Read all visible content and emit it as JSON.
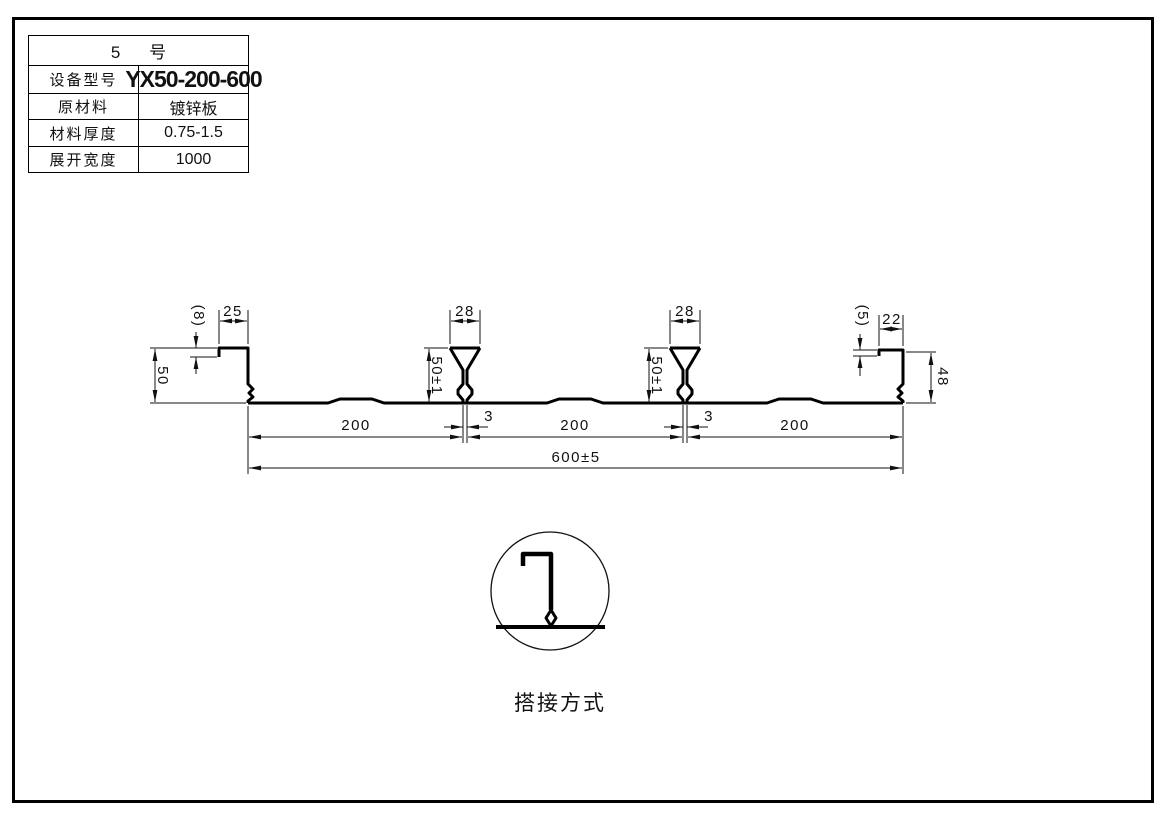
{
  "table": {
    "title": "5 号",
    "rows": [
      {
        "label": "设备型号",
        "value": "YX50-200-600"
      },
      {
        "label": "原材料",
        "value": "镀锌板"
      },
      {
        "label": "材料厚度",
        "value": "0.75-1.5"
      },
      {
        "label": "展开宽度",
        "value": "1000"
      }
    ]
  },
  "dimensions": {
    "left_height": "50",
    "left_lip": "(8)",
    "left_flange": "25",
    "rib1_top": "28",
    "rib1_height": "50±1",
    "rib1_base": "3",
    "rib2_top": "28",
    "rib2_height": "50±1",
    "rib2_base": "3",
    "right_lip": "(5)",
    "right_flange": "22",
    "right_height": "48",
    "span1": "200",
    "span2": "200",
    "span3": "200",
    "total_width": "600±5"
  },
  "detail": {
    "caption": "搭接方式"
  },
  "colors": {
    "line": "#111111",
    "background": "#ffffff"
  }
}
